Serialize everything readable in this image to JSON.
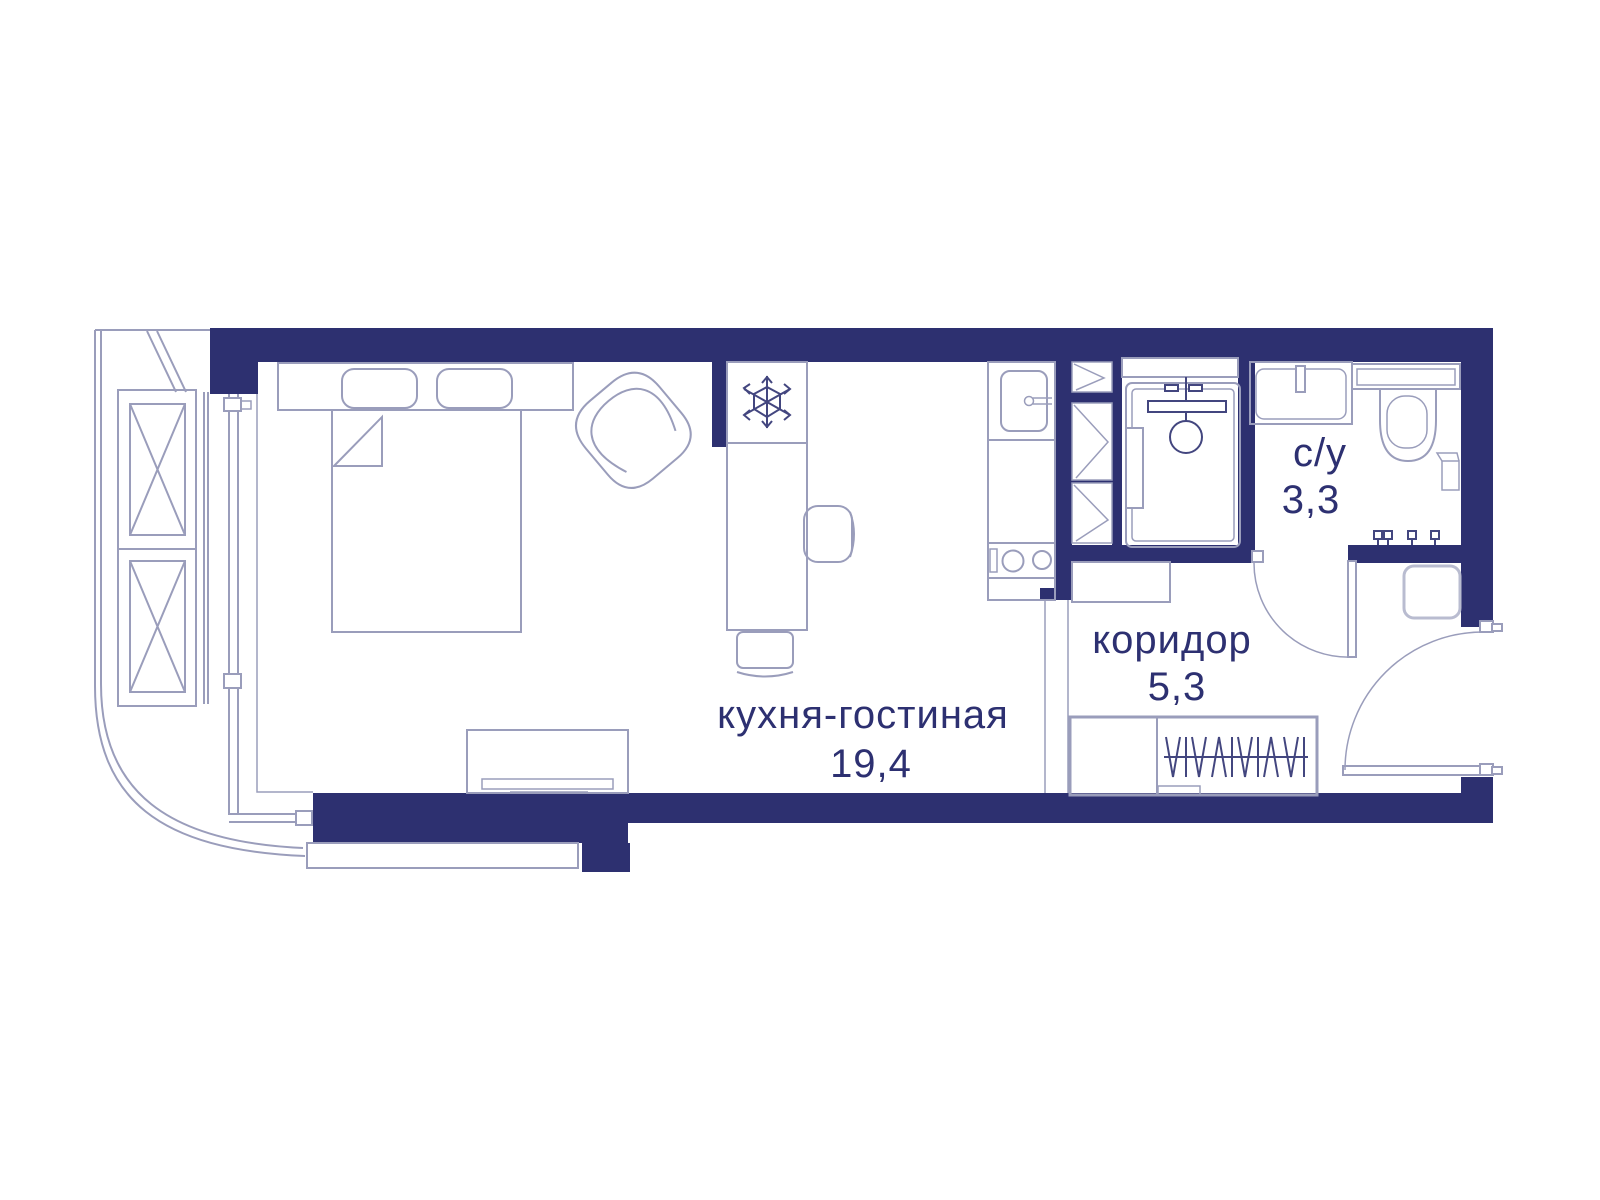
{
  "floorplan": {
    "type": "apartment-floor-plan",
    "rooms": [
      {
        "name": "кухня-гостиная",
        "area": "19,4"
      },
      {
        "name": "коридор",
        "area": "5,3"
      },
      {
        "name": "с/у",
        "area": "3,3"
      }
    ]
  },
  "colors": {
    "background": "#ffffff",
    "wall": "#2d3070",
    "line": "#9a9dbb",
    "line_dark": "#43467f",
    "line_light": "#b9bcd0",
    "text": "#2d3071"
  },
  "icons": {
    "fridge": "snowflake-icon",
    "shower": "shower-head-icon",
    "wardrobe": "clothes-hangers-icon",
    "hooks": "towel-hook-icon"
  }
}
